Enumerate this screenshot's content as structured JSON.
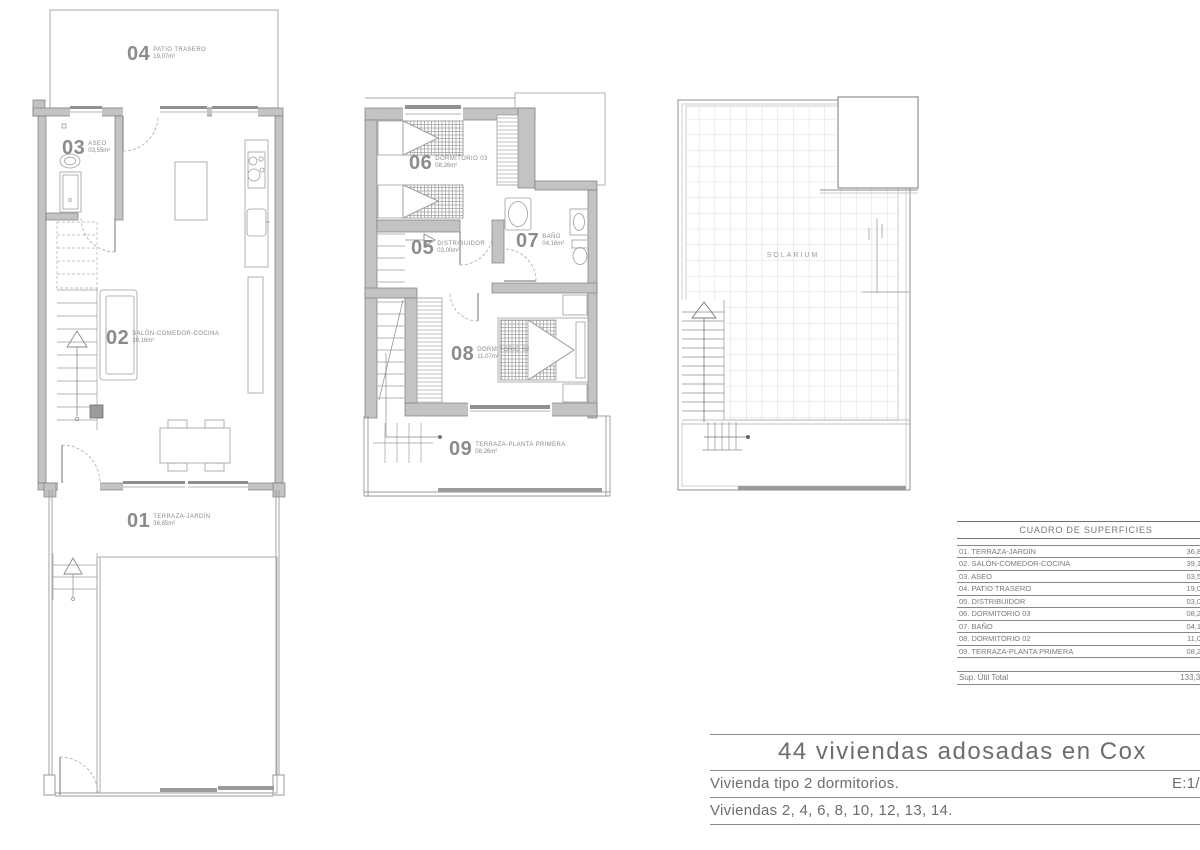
{
  "plans": {
    "ground_floor": {
      "rooms": [
        {
          "number": "04",
          "name": "PATIO TRASERO",
          "area": "19,07m²"
        },
        {
          "number": "03",
          "name": "ASEO",
          "area": "03,55m²"
        },
        {
          "number": "02",
          "name": "SALÓN-COMEDOR-COCINA",
          "area": "39,16m²"
        },
        {
          "number": "01",
          "name": "TERRAZA-JARDÍN",
          "area": "36,85m²"
        }
      ]
    },
    "first_floor": {
      "rooms": [
        {
          "number": "06",
          "name": "DORMITORIO 03",
          "area": "08,26m²"
        },
        {
          "number": "05",
          "name": "DISTRIBUIDOR",
          "area": "03,00m²"
        },
        {
          "number": "07",
          "name": "BAÑO",
          "area": "04,16m²"
        },
        {
          "number": "08",
          "name": "DORMITORIO 02",
          "area": "11,07m²"
        },
        {
          "number": "09",
          "name": "TERRAZA-PLANTA PRIMERA",
          "area": "08,26m²"
        }
      ]
    },
    "roof": {
      "label": "SOLARIUM"
    }
  },
  "surface_table": {
    "title": "CUADRO DE SUPERFICIES",
    "rows": [
      {
        "label": "01. TERRAZA-JARDÍN",
        "value": "36,85m²"
      },
      {
        "label": "02. SALÓN-COMEDOR-COCINA",
        "value": "39,16m²"
      },
      {
        "label": "03. ASEO",
        "value": "03,55m²"
      },
      {
        "label": "04. PATIO TRASERO",
        "value": "19,07m²"
      },
      {
        "label": "05. DISTRIBUIDOR",
        "value": "03,00m²"
      },
      {
        "label": "06. DORMITORIO 03",
        "value": "08,26m²"
      },
      {
        "label": "07. BAÑO",
        "value": "04,16m²"
      },
      {
        "label": "08. DORMITORIO 02",
        "value": "11,07m²"
      },
      {
        "label": "09. TERRAZA-PLANTA PRIMERA",
        "value": "08,26m²"
      }
    ],
    "total_label": "Sup. Útil Total",
    "total_value": "133,38m²"
  },
  "title_block": {
    "project_title": "44 viviendas adosadas en Cox",
    "dwelling_type": "Vivienda tipo 2 dormitorios.",
    "scale": "E:1/7",
    "dwelling_numbers": "Viviendas 2, 4, 6, 8, 10, 12, 13, 14."
  },
  "colors": {
    "wall_fill": "#c3c3c3",
    "wall_edge": "#7d7d7d",
    "thin_line": "#9e9e9e",
    "grid": "#d2d2d2",
    "label": "#8c8c8c"
  }
}
